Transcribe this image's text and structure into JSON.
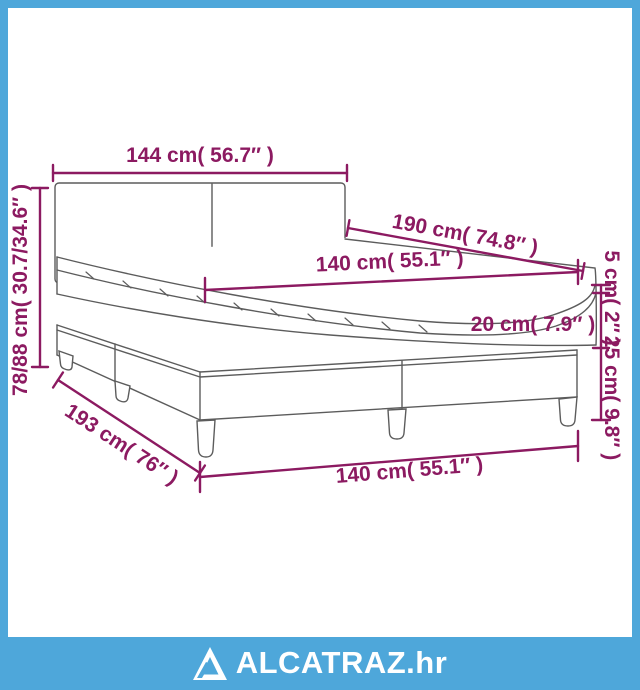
{
  "page": {
    "background_color": "#ffffff",
    "border_color": "#4EA7DA",
    "accent_color": "#8C1A61",
    "line_color": "#5c5c5c"
  },
  "dimensions": {
    "headboard_width": "144 cm( 56.7″ )",
    "total_height_range": "78/88 cm( 30.7/34.6″ )",
    "bed_length": "190 cm( 74.8″ )",
    "mattress_width_top": "140 cm( 55.1″ )",
    "topper_height": "5 cm( 2″ )",
    "mattress_height": "20 cm( 7.9″ )",
    "base_height": "25 cm( 9.8″ )",
    "base_diagonal_length": "193 cm( 76″ )",
    "base_width_bottom": "140 cm( 55.1″ )"
  },
  "footer": {
    "brand": "ALCATRAZ.hr",
    "logo": "alcatraz-triangle-logo",
    "bar_color": "#4EA7DA",
    "text_color": "#ffffff"
  }
}
